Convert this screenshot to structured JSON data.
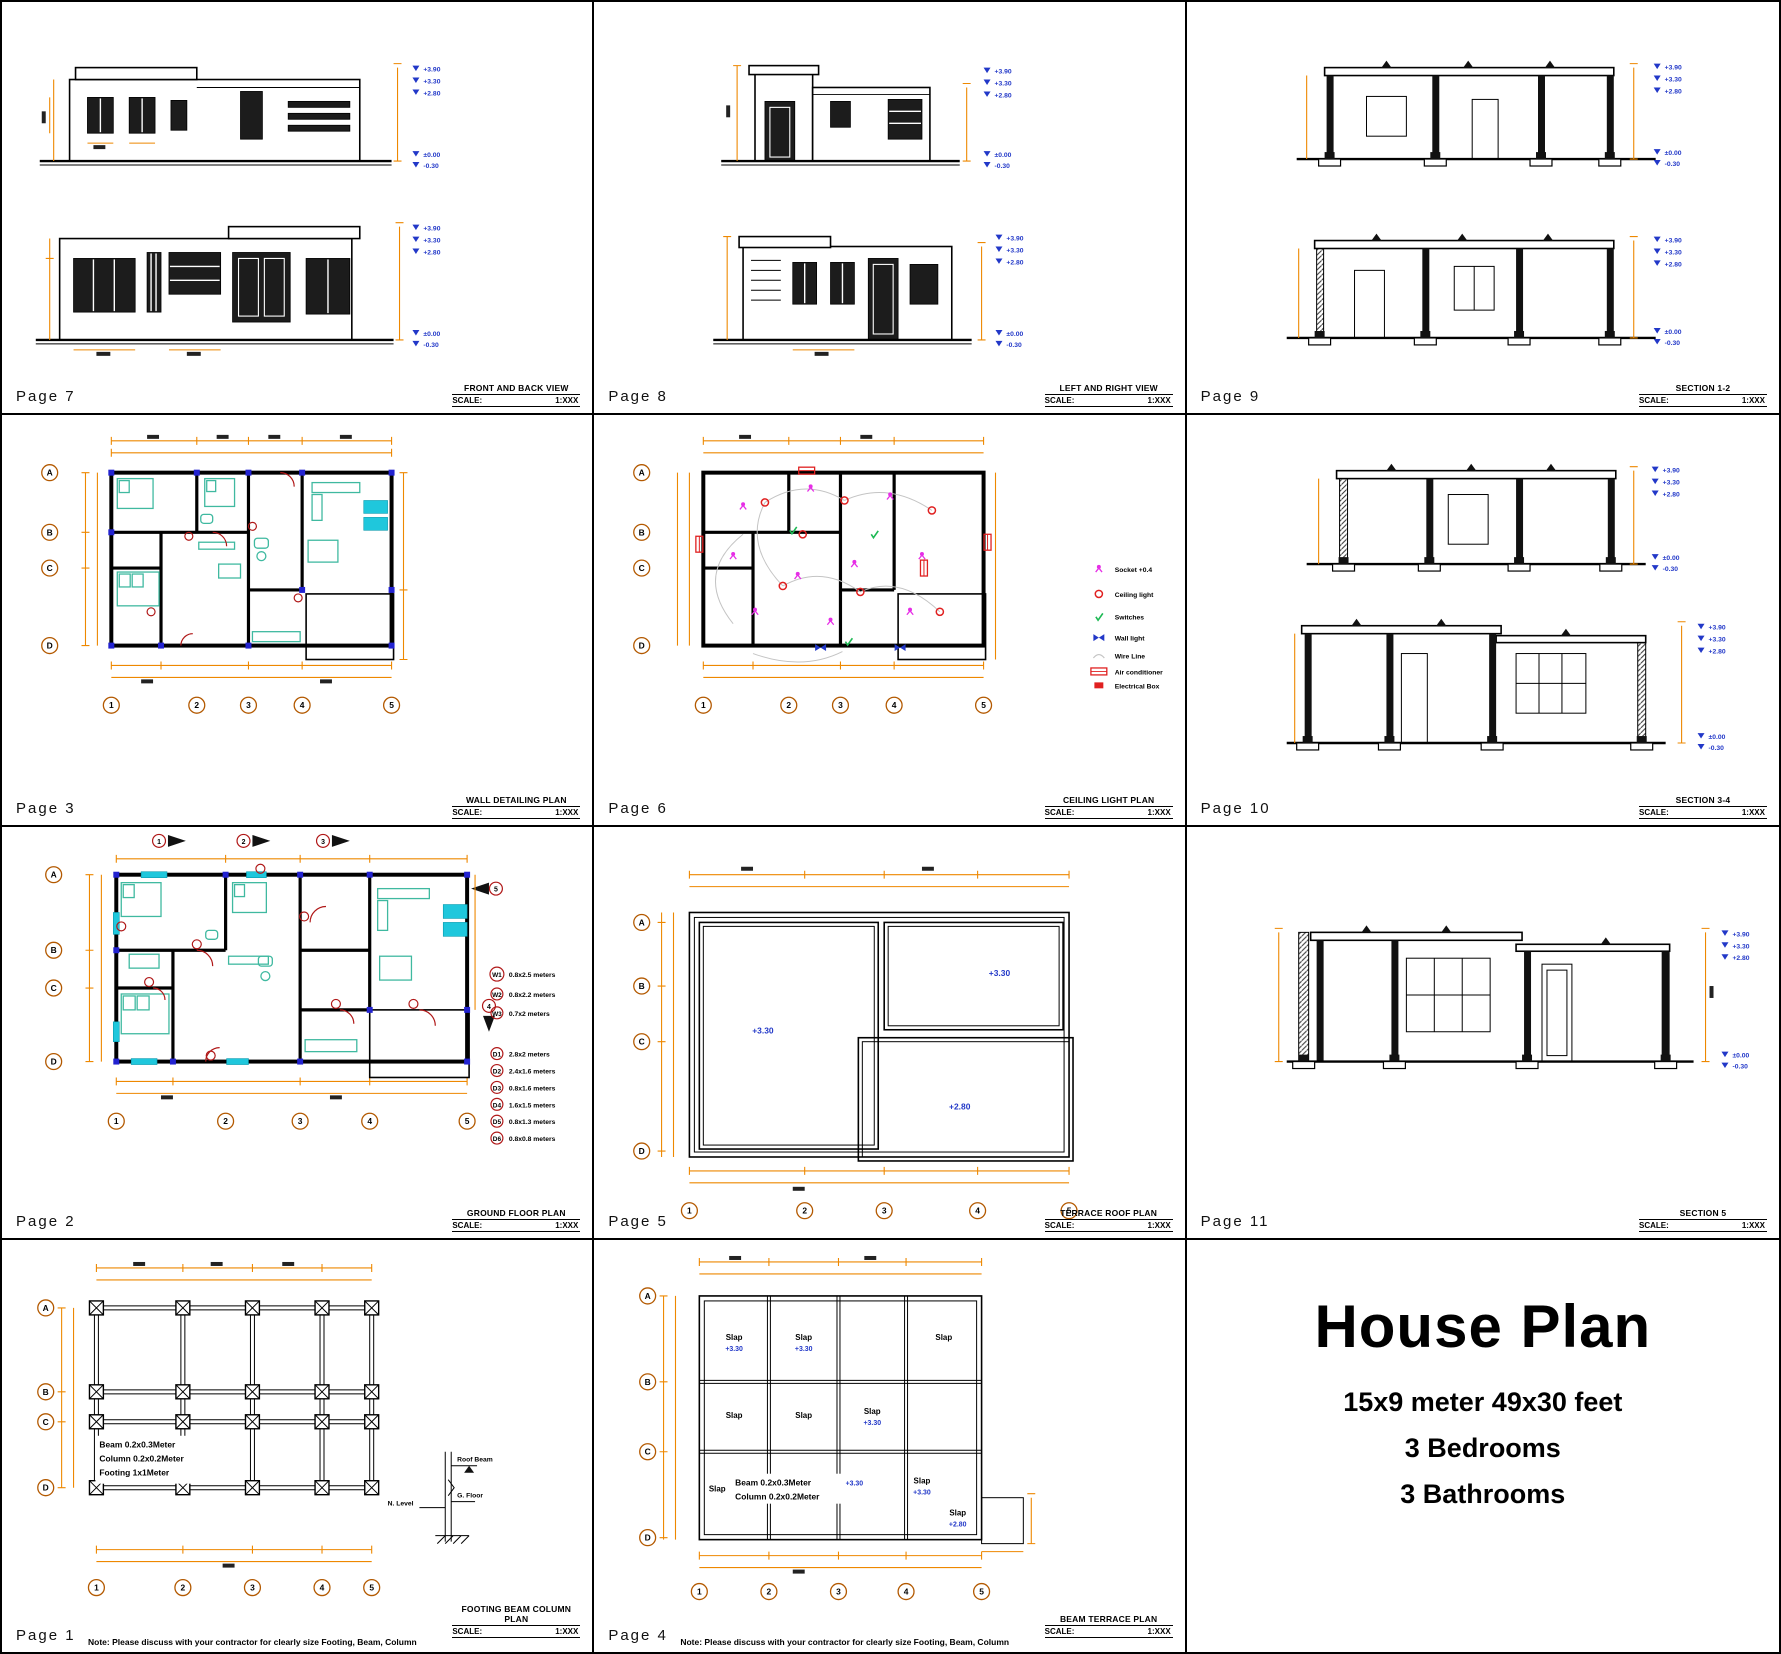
{
  "colors": {
    "dimension_orange": "#EE8800",
    "level_blue": "#2238C8",
    "furniture_teal": "#3FB9A0",
    "window_cyan": "#1FC7DC",
    "socket_magenta": "#E62EE6",
    "light_red": "#E02020",
    "switch_green": "#1DB954",
    "axis_brown": "#B35900",
    "column_blue": "#2222D0",
    "door_dark_red": "#B01818"
  },
  "levels": {
    "top": [
      "+3.90",
      "+3.30",
      "+2.80"
    ],
    "ground": [
      "±0.00",
      "-0.30"
    ]
  },
  "axes": {
    "rows": [
      "A",
      "B",
      "C",
      "D"
    ],
    "cols": [
      "1",
      "2",
      "3",
      "4",
      "5"
    ]
  },
  "scale_label": "SCALE:",
  "scale_value": "1:XXX",
  "note": "Note: Please discuss with your contractor for clearly size Footing, Beam, Column",
  "panels": {
    "p7": {
      "page": "Page 7",
      "title": "FRONT AND BACK VIEW"
    },
    "p8": {
      "page": "Page 8",
      "title": "LEFT AND RIGHT VIEW"
    },
    "p9": {
      "page": "Page 9",
      "title": "SECTION 1-2"
    },
    "p3": {
      "page": "Page 3",
      "title": "WALL DETAILING PLAN"
    },
    "p6": {
      "page": "Page 6",
      "title": "CEILING LIGHT PLAN",
      "legend": [
        {
          "icon": "socket-icon",
          "label": "Socket +0.4"
        },
        {
          "icon": "ceiling-light-icon",
          "label": "Ceiling light"
        },
        {
          "icon": "switch-icon",
          "label": "Switches"
        },
        {
          "icon": "wall-light-icon",
          "label": "Wall light"
        },
        {
          "icon": "wire-line-icon",
          "label": "Wire Line"
        },
        {
          "icon": "air-conditioner-icon",
          "label": "Air conditioner"
        },
        {
          "icon": "electrical-box-icon",
          "label": "Electrical Box"
        }
      ]
    },
    "p10": {
      "page": "Page 10",
      "title": "SECTION 3-4"
    },
    "p2": {
      "page": "Page 2",
      "title": "GROUND FLOOR PLAN",
      "section_marks": [
        "1",
        "2",
        "3",
        "4",
        "5"
      ],
      "windows": [
        {
          "id": "W1",
          "size": "0.8x2.5 meters"
        },
        {
          "id": "W2",
          "size": "0.8x2.2 meters"
        },
        {
          "id": "W3",
          "size": "0.7x2 meters"
        }
      ],
      "doors": [
        {
          "id": "D1",
          "size": "2.8x2 meters"
        },
        {
          "id": "D2",
          "size": "2.4x1.6 meters"
        },
        {
          "id": "D3",
          "size": "0.8x1.6 meters"
        },
        {
          "id": "D4",
          "size": "1.6x1.5 meters"
        },
        {
          "id": "D5",
          "size": "0.8x1.3 meters"
        },
        {
          "id": "D6",
          "size": "0.8x0.8 meters"
        }
      ]
    },
    "p5": {
      "page": "Page 5",
      "title": "TERRACE ROOF PLAN",
      "roof_levels": [
        "+3.30",
        "+3.30",
        "+2.80"
      ]
    },
    "p11": {
      "page": "Page 11",
      "title": "SECTION 5"
    },
    "p1": {
      "page": "Page 1",
      "title": "FOOTING BEAM COLUMN PLAN",
      "specs": [
        "Beam  0.2x0.3Meter",
        "Column  0.2x0.2Meter",
        "Footing  1x1Meter"
      ],
      "detail_labels": {
        "roof_beam": "Roof Beam",
        "g_floor": "G. Floor",
        "n_level": "N. Level"
      }
    },
    "p4": {
      "page": "Page 4",
      "title": "BEAM TERRACE PLAN",
      "specs": [
        "Beam  0.2x0.3Meter",
        "Column  0.2x0.2Meter"
      ],
      "spec_level": "+3.30",
      "slabs": [
        {
          "label": "Slap",
          "level": "+3.30"
        },
        {
          "label": "Slap",
          "level": "+3.30"
        },
        {
          "label": "Slap",
          "level": ""
        },
        {
          "label": "Slap",
          "level": ""
        },
        {
          "label": "Slap",
          "level": ""
        },
        {
          "label": "Slap",
          "level": "+3.30"
        },
        {
          "label": "Slap",
          "level": ""
        },
        {
          "label": "Slap",
          "level": "+3.30"
        },
        {
          "label": "Slap",
          "level": "+2.80"
        }
      ]
    },
    "title_block": {
      "title": "House Plan",
      "line1": "15x9 meter 49x30 feet",
      "line2": "3 Bedrooms",
      "line3": "3 Bathrooms"
    }
  }
}
